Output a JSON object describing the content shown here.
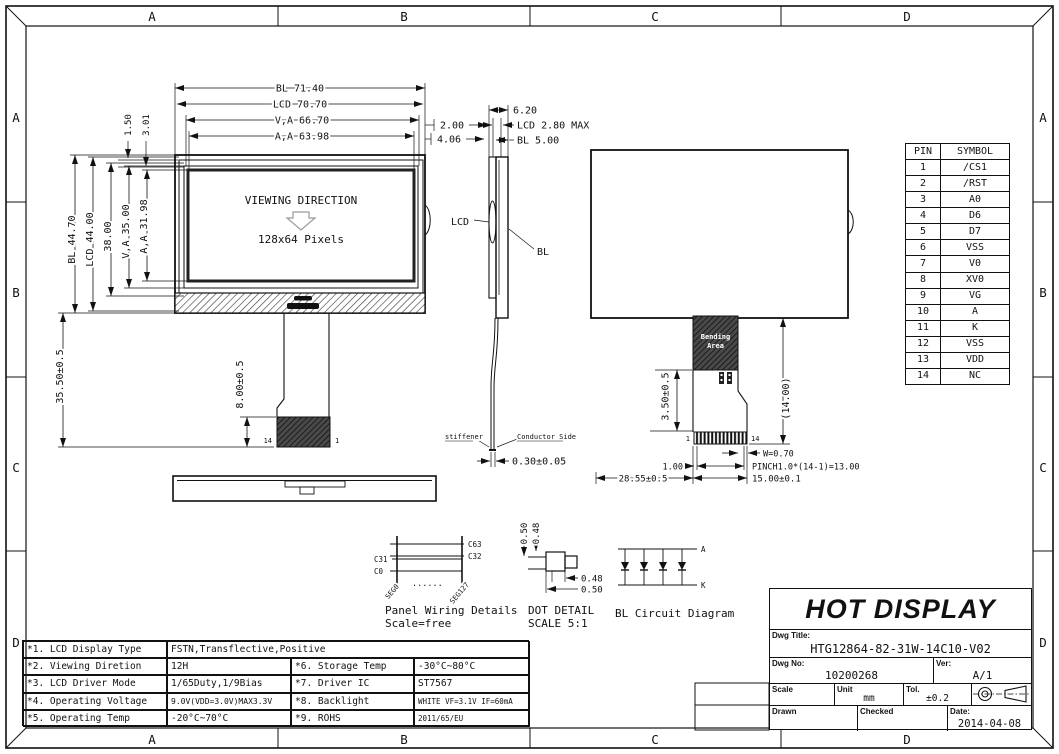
{
  "frame": {
    "cols": [
      "A",
      "B",
      "C",
      "D"
    ],
    "rows": [
      "A",
      "B",
      "C",
      "D"
    ]
  },
  "front_view": {
    "w_bl": "BL 71.40",
    "w_lcd": "LCD 70.70",
    "w_va": "V,A 66.70",
    "w_aa": "A,A 63.98",
    "gap_150": "1.50",
    "gap_301": "3.01",
    "h_bl": "BL 44.70",
    "h_lcd": "LCD 44.00",
    "h_38": "38.00",
    "h_va": "V,A 35.00",
    "h_aa": "A,A 31.98",
    "viewing": "VIEWING DIRECTION",
    "pixels": "128x64 Pixels",
    "fpc_len": "35.50±0.5",
    "tail_len": "8.00±0.5",
    "pin_l": "14",
    "pin_r": "1"
  },
  "side_view": {
    "w_620": "6.20",
    "lcd_max": "LCD 2.80 MAX",
    "bl_500": "BL 5.00",
    "off_200": "2.00",
    "off_406": "4.06",
    "lbl_lcd": "LCD",
    "lbl_bl": "BL",
    "stiffener": "stiffener",
    "conductor": "Conductor Side",
    "thick": "0.30±0.05"
  },
  "back_view": {
    "dim_350": "3.50±0.5",
    "dim_14": "(14.00)",
    "bend1": "Bending",
    "bend2": "Area",
    "pin_1": "1",
    "pin_14": "14",
    "dim_w": "W=0.70",
    "dim_pitch": "PINCH1.0*(14-1)=13.00",
    "dim_100": "1.00",
    "dim_2855": "28.55±0.5",
    "dim_1500": "15.00±0.1"
  },
  "pin_table": {
    "header": {
      "pin": "PIN",
      "symbol": "SYMBOL"
    },
    "rows": [
      {
        "pin": "1",
        "symbol": "/CS1"
      },
      {
        "pin": "2",
        "symbol": "/RST"
      },
      {
        "pin": "3",
        "symbol": "A0"
      },
      {
        "pin": "4",
        "symbol": "D6"
      },
      {
        "pin": "5",
        "symbol": "D7"
      },
      {
        "pin": "6",
        "symbol": "VSS"
      },
      {
        "pin": "7",
        "symbol": "V0"
      },
      {
        "pin": "8",
        "symbol": "XV0"
      },
      {
        "pin": "9",
        "symbol": "VG"
      },
      {
        "pin": "10",
        "symbol": "A"
      },
      {
        "pin": "11",
        "symbol": "K"
      },
      {
        "pin": "12",
        "symbol": "VSS"
      },
      {
        "pin": "13",
        "symbol": "VDD"
      },
      {
        "pin": "14",
        "symbol": "NC"
      }
    ]
  },
  "panel_wiring": {
    "c63": "C63",
    "c32": "C32",
    "c31": "C31",
    "c0": "C0",
    "seg0": "SEG0",
    "seg127": "SEG127",
    "dots": "......",
    "title": "Panel Wiring Details",
    "scale": "Scale=free"
  },
  "dot_detail": {
    "v050": "0.50",
    "v048": "0.48",
    "h048": "0.48",
    "h050": "0.50",
    "title": "DOT DETAIL",
    "scale": "SCALE 5:1"
  },
  "bl_circuit": {
    "anode": "A",
    "cathode": "K",
    "title": "BL Circuit Diagram"
  },
  "spec_table": {
    "rows": [
      {
        "label": "*1. LCD Display Type",
        "value": "FSTN,Transflective,Positive"
      },
      {
        "label": "*2. Viewing Diretion",
        "value": "12H",
        "label2": "*6. Storage Temp",
        "value2": "-30°C~80°C"
      },
      {
        "label": "*3. LCD Driver Mode",
        "value": "1/65Duty,1/9Bias",
        "label2": "*7. Driver IC",
        "value2": "ST7567"
      },
      {
        "label": "*4. Operating Voltage",
        "value": "9.0V(VDD=3.0V)MAX3.3V",
        "label2": "*8. Backlight",
        "value2": "WHITE VF=3.1V IF=60mA"
      },
      {
        "label": "*5. Operating Temp",
        "value": "-20°C~70°C",
        "label2": "*9. ROHS",
        "value2": "2011/65/EU"
      }
    ]
  },
  "title_block": {
    "company": "HOT DISPLAY",
    "dwg_title_label": "Dwg Title:",
    "dwg_title": "HTG12864-82-31W-14C10-V02",
    "dwg_no_label": "Dwg No:",
    "dwg_no": "10200268",
    "ver_label": "Ver:",
    "ver": "A/1",
    "scale_label": "Scale",
    "unit_label": "Unit",
    "unit": "mm",
    "tol_label": "Tol.",
    "tol": "±0.2",
    "drawn_label": "Drawn",
    "checked_label": "Checked",
    "date_label": "Date:",
    "date": "2014-04-08"
  }
}
